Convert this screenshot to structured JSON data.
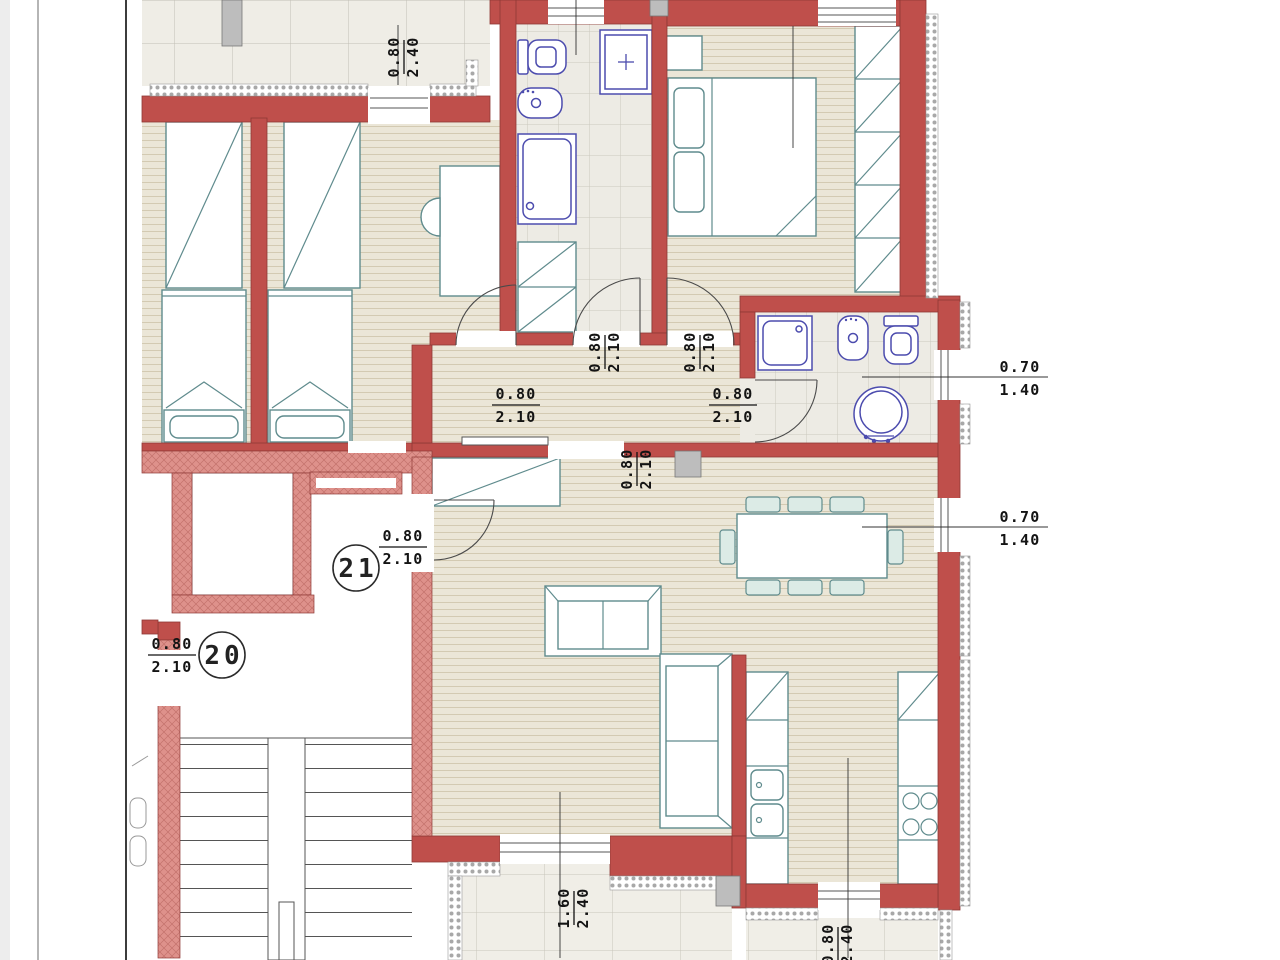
{
  "colors": {
    "wall_red": "#BF4F4B",
    "wall_outline": "#8E3835",
    "hatch_pink": "#DE918B",
    "floor_beige": "#EBE6D7",
    "tile_gray": "#EDEBE4",
    "fixture_blue": "#4C4CAE",
    "furniture_teal": "#5F8B8D",
    "chair_fill": "#DCEBE6",
    "dim_text": "#141414"
  },
  "units": {
    "apt20": "20",
    "apt21": "21"
  },
  "labels": {
    "terrace_door": {
      "w": "0.80",
      "h": "2.40"
    },
    "bedroom_door": {
      "w": "0.80",
      "h": "2.10"
    },
    "bath_door": {
      "w": "0.80",
      "h": "2.10"
    },
    "master_door": {
      "w": "0.80",
      "h": "2.10"
    },
    "bath2_door": {
      "w": "0.80",
      "h": "2.10"
    },
    "slider_door": {
      "w": "0.80",
      "h": "2.10"
    },
    "apt21_door": {
      "w": "0.80",
      "h": "2.10"
    },
    "apt20_door": {
      "w": "0.80",
      "h": "2.10"
    },
    "bath2_window": {
      "w": "0.70",
      "h": "1.40"
    },
    "living_window": {
      "w": "0.70",
      "h": "1.40"
    },
    "balcony_door": {
      "w": "1.60",
      "h": "2.40"
    },
    "kitchen_door": {
      "w": "0.80",
      "h": "2.40"
    }
  }
}
